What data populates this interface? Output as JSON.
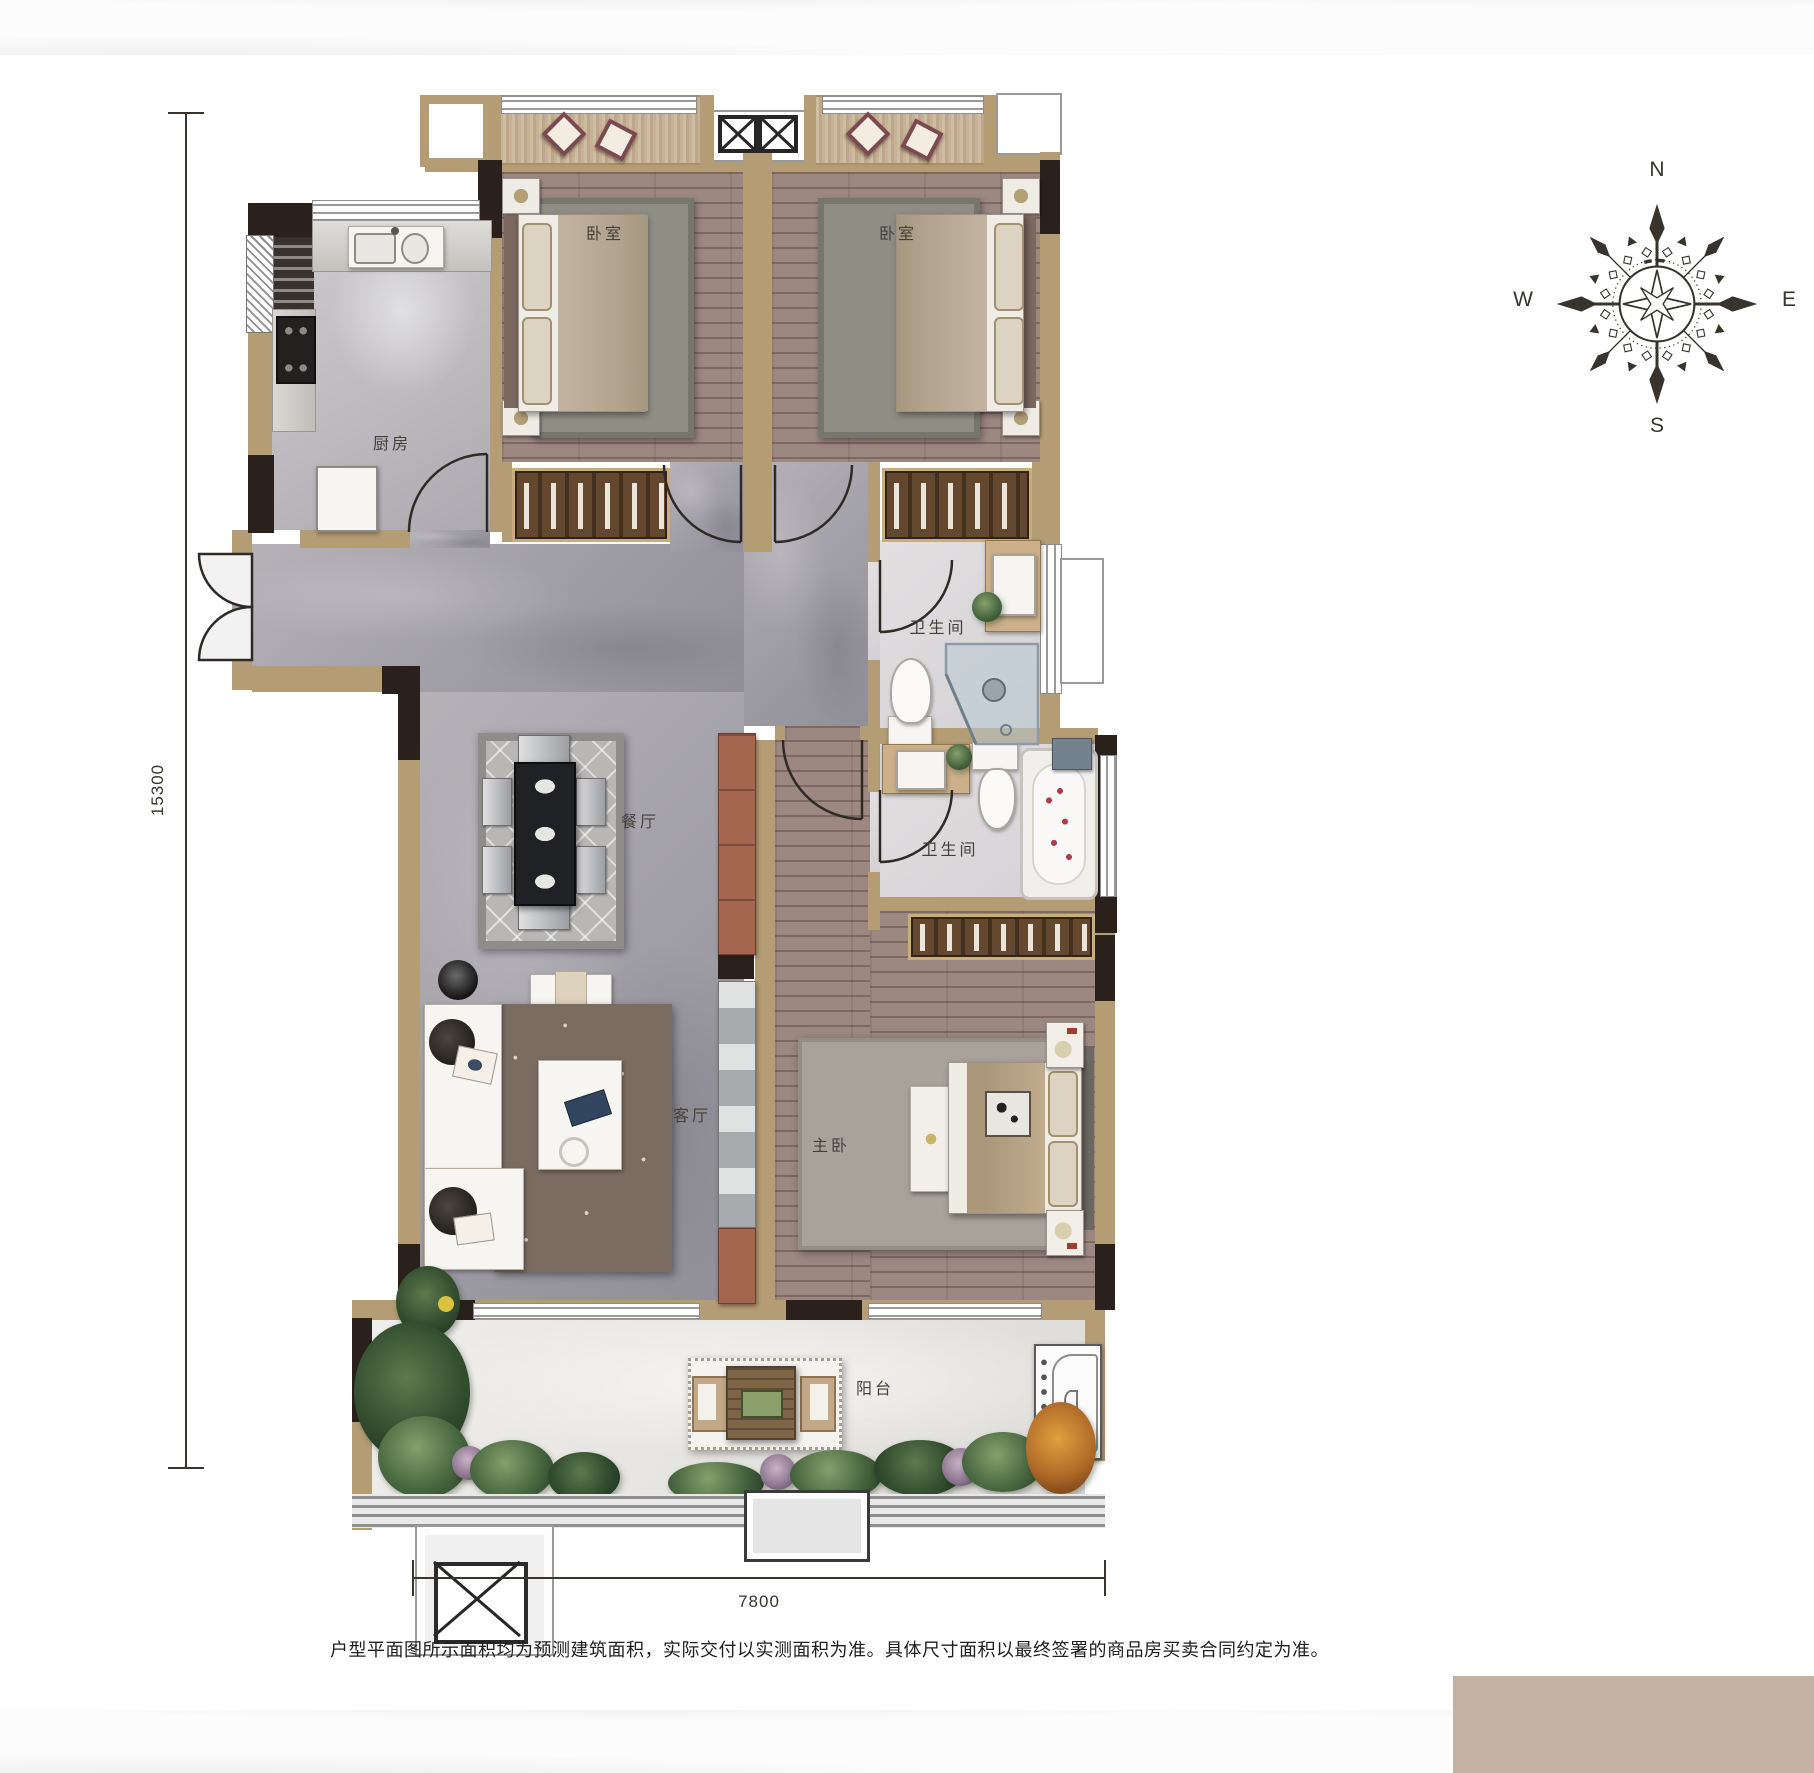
{
  "rooms": {
    "bedroom1": "卧室",
    "bedroom2": "卧室",
    "kitchen": "厨房",
    "bathroom1": "卫生间",
    "bathroom2": "卫生间",
    "dining": "餐厅",
    "living": "客厅",
    "master": "主卧",
    "balcony": "阳台"
  },
  "compass": {
    "north": "N",
    "south": "S",
    "east": "E",
    "west": "W"
  },
  "dimensions": {
    "vertical_mm": "15300",
    "horizontal_mm": "7800"
  },
  "footnote": "户型平面图所示面积均为预测建筑面积，实际交付以实测面积为准。具体尺寸面积以最终签署的商品房买卖合同约定为准。",
  "colors": {
    "wall_tan": "#b49c74",
    "wall_dark": "#2a211c",
    "panel_tan": "#c3b1a4",
    "wood_floor": "#9c8781",
    "stone_floor": "#a6a4aa",
    "bath_floor": "#dcdadb",
    "balcony_floor": "#eae8e5",
    "line_dark": "#3a342e"
  }
}
